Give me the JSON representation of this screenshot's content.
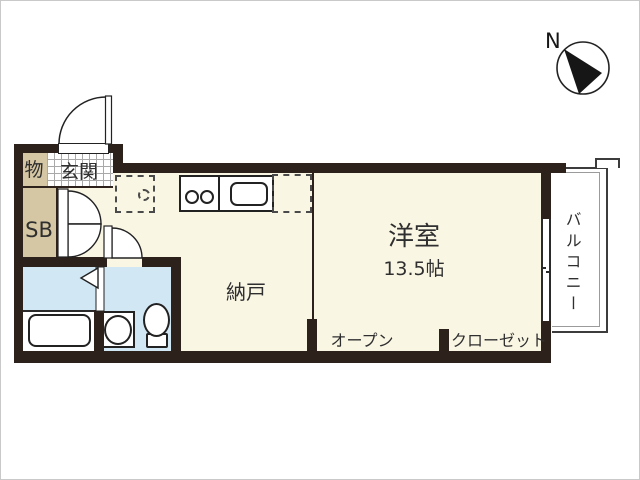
{
  "plan_title": "apartment-floor-plan",
  "compass": {
    "north_label": "N"
  },
  "rooms": {
    "storage_small": {
      "label": "物"
    },
    "entrance": {
      "label": "玄関"
    },
    "shoe_box": {
      "label": "SB"
    },
    "storage_room": {
      "label": "納戸"
    },
    "western_room": {
      "label": "洋室",
      "size": "13.5帖"
    },
    "open_storage": {
      "label": "オープン"
    },
    "closet": {
      "label": "クローゼット"
    },
    "balcony": {
      "label": "バルコニー"
    }
  },
  "colors": {
    "wall": "#2d221b",
    "floor_main": "#faf6e4",
    "floor_storage": "#d5c6a4",
    "floor_wet_area": "#d2e7f4",
    "line": "#222222"
  }
}
